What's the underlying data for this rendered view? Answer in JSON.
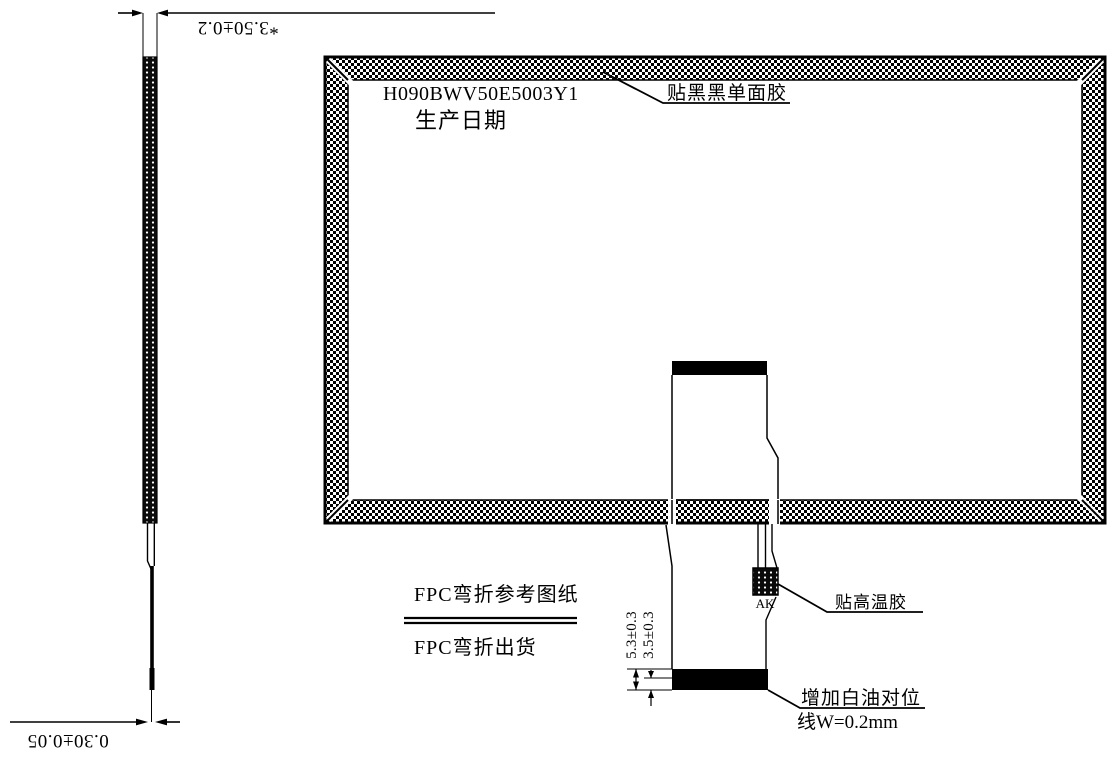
{
  "page": {
    "background": "#ffffff",
    "line_color": "#000000"
  },
  "panel": {
    "part_number": "H090BWV50E5003Y1",
    "production_date_label": "生产日期",
    "black_tape_note": "贴黑黑单面胶"
  },
  "fpc": {
    "ak_label": "AK",
    "high_temp_tape_note": "贴高温胶",
    "white_oil_note_line1": "增加白油对位",
    "white_oil_note_line2": "线W=0.2mm",
    "bend_reference_label": "FPC弯折参考图纸",
    "bend_shipping_label": "FPC弯折出货",
    "stiffener_total_dim": "5.3±0.3",
    "stiffener_bar_dim": "3.5±0.3"
  },
  "side_view": {
    "total_thickness_dim": "*3.50±0.2",
    "fpc_thickness_dim": "0.30±0.05"
  }
}
